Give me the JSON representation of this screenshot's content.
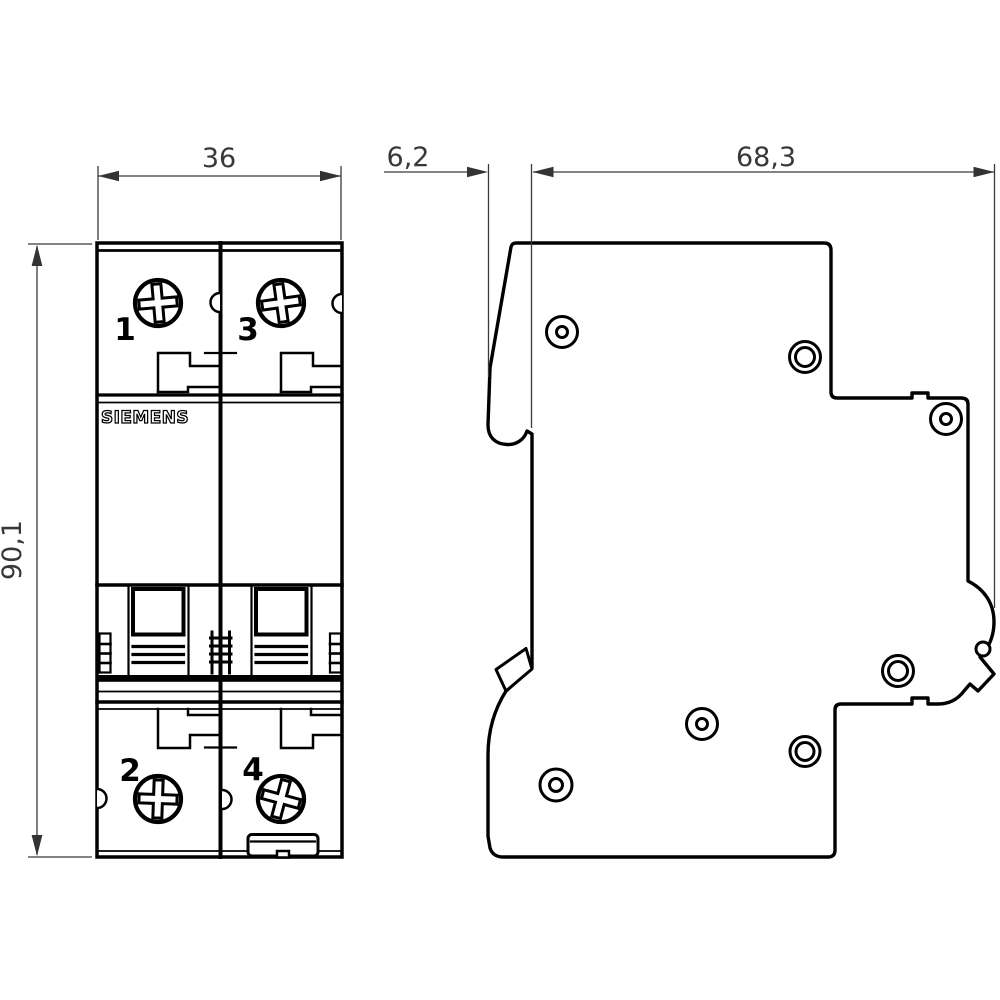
{
  "brand_label": "SIEMENS",
  "dimensions": {
    "width": "36",
    "height": "90,1",
    "front_depth": "6,2",
    "total_depth": "68,3"
  },
  "terminal_labels": {
    "top_left": "1",
    "top_right": "3",
    "bottom_left": "2",
    "bottom_right": "4"
  },
  "colors": {
    "outline": "#000000",
    "dimension_line": "#3a3a3a",
    "background": "#ffffff"
  }
}
